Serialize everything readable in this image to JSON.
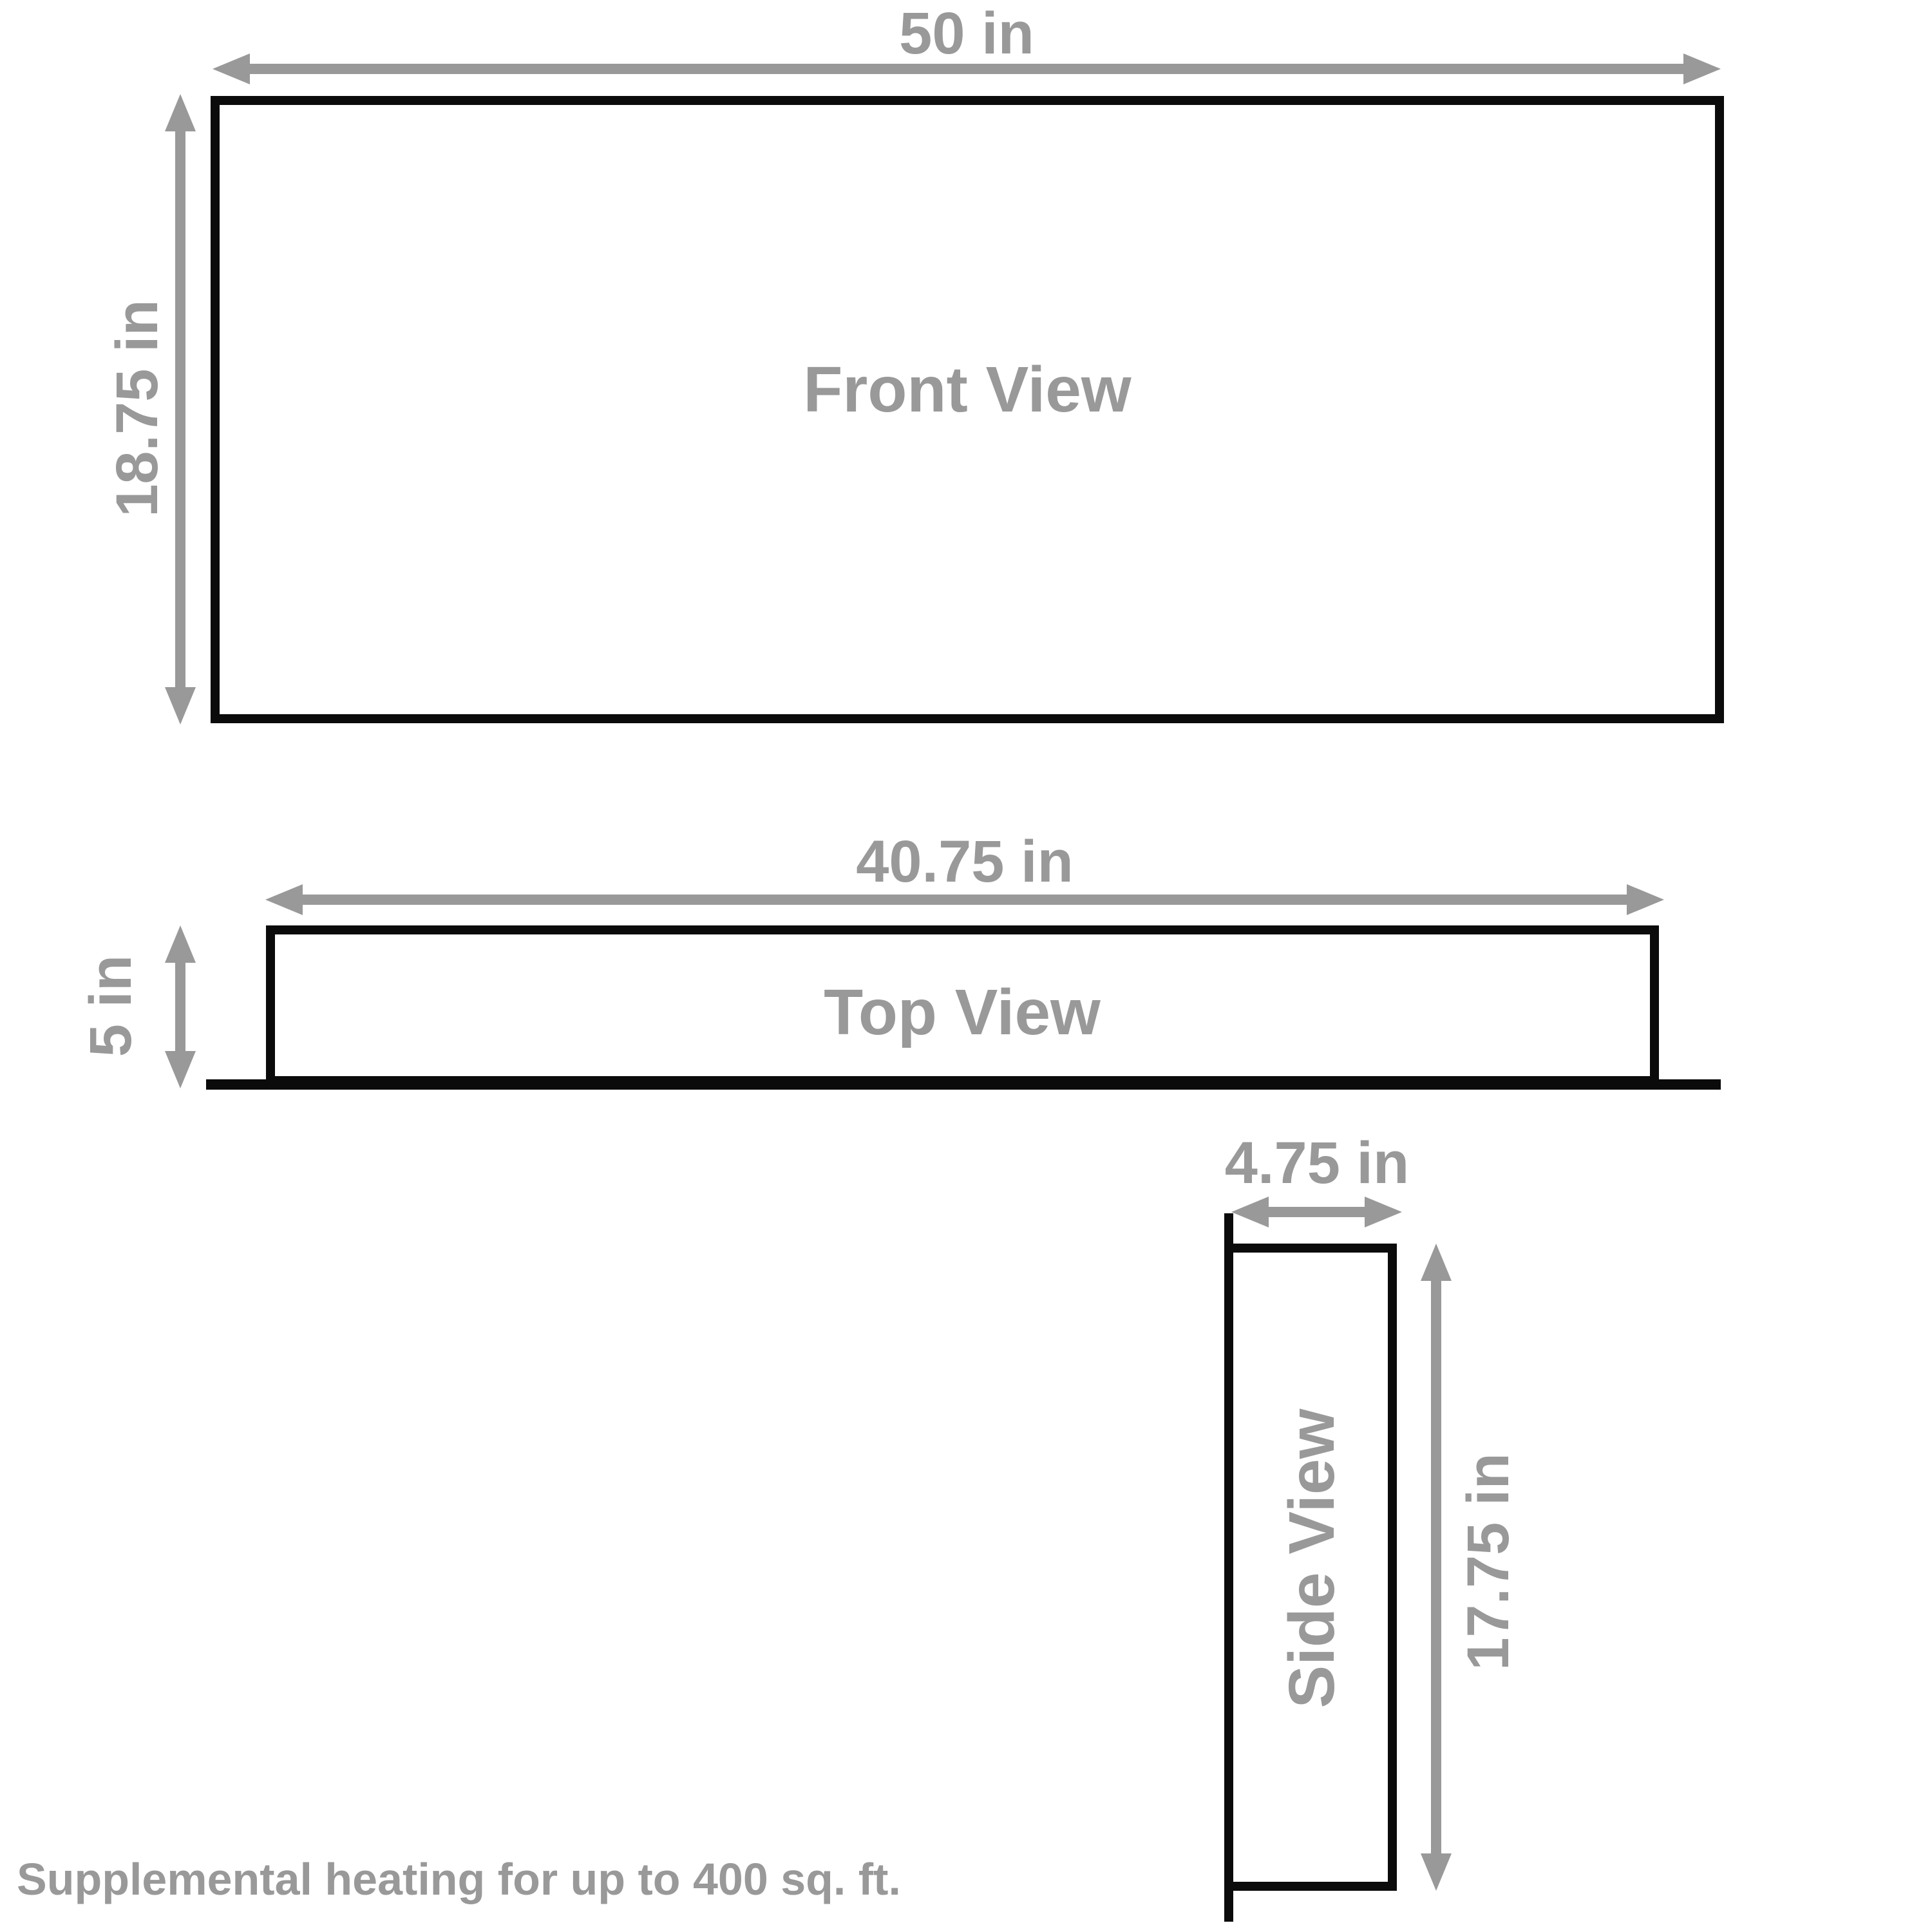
{
  "diagram": {
    "views": [
      {
        "name": "Front View",
        "width_label": "50 in",
        "height_label": "18.75 in"
      },
      {
        "name": "Top View",
        "width_label": "40.75 in",
        "height_label": "5 in"
      },
      {
        "name": "Side View",
        "width_label": "4.75 in",
        "height_label": "17.75 in"
      }
    ],
    "footnote": "Supplemental heating for up to 400 sq. ft.",
    "colors": {
      "outline": "#0b0b0b",
      "dimension": "#999999",
      "background": "#ffffff"
    }
  }
}
